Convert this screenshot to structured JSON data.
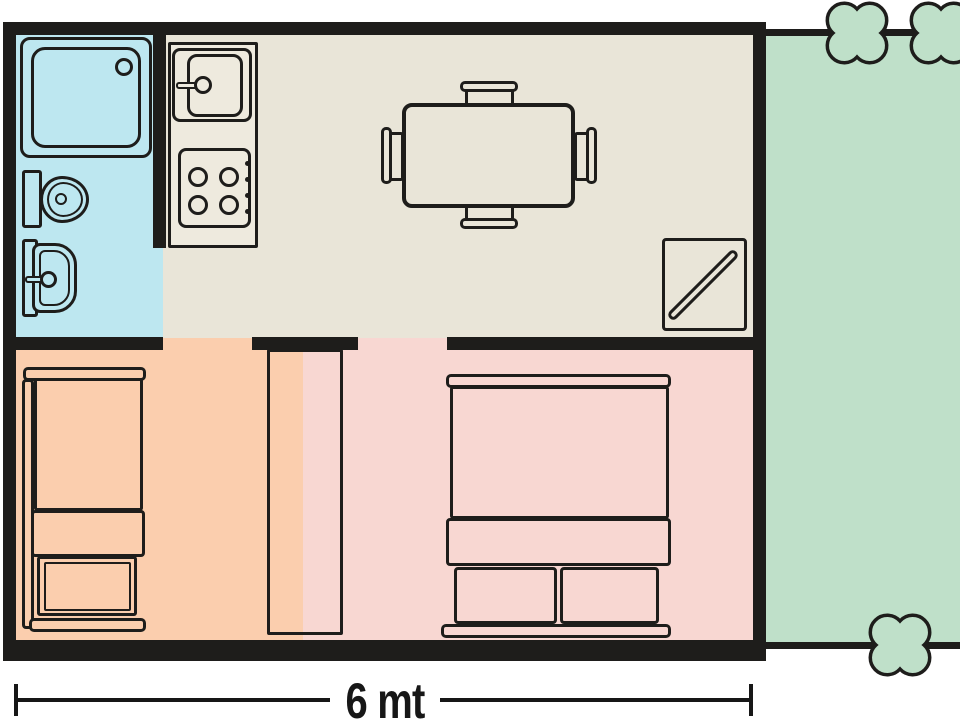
{
  "dimension": {
    "label": "6 mt"
  },
  "colors": {
    "wall": "#1e1d1b",
    "bathroom": "#bde7f0",
    "kitchen": "#e9e5d8",
    "kitchen_unit": "#eeeade",
    "bedroom_single": "#fbceae",
    "bedroom_double": "#f8d7d2",
    "garden": "#bfe0c9",
    "background": "#ffffff",
    "text": "#171717"
  },
  "icons": {
    "bush": "quatrefoil-clover shape on garden border",
    "shower": "rounded square tray with drain circle",
    "toilet": "tank rectangle with oval bowl",
    "washbasin": "rounded basin with faucet knob",
    "kitchen_sink": "double rounded square with faucet knob",
    "stove": "four burner circles with side knobs",
    "dining_table": "rectangle with four chairs",
    "wardrobe_divider": "tall rectangle between bedrooms",
    "single_bed": "bunk bed seen from above",
    "double_bed": "bed with two pillows seen from above",
    "entrance_mat": "square with diagonal handle"
  }
}
